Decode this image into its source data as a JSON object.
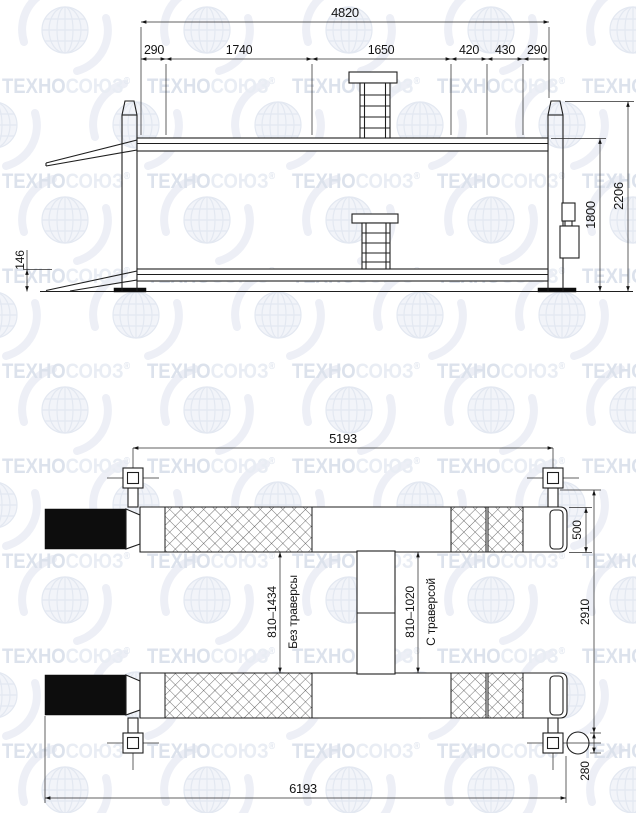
{
  "title": "Four-post lift dimensional drawing",
  "watermark": {
    "brand_left": "ТЕХНО",
    "brand_right": "СОЮЗ",
    "registered": "®"
  },
  "side_view": {
    "dim_overall_length": "4820",
    "dim_segments": [
      "290",
      "1740",
      "1650",
      "420",
      "430",
      "290"
    ],
    "dim_column_height": "2206",
    "dim_lift_height": "1800",
    "dim_platform_profile": "146"
  },
  "plan_view": {
    "dim_span_post_centers": "5193",
    "dim_overall_length": "6193",
    "dim_runway_width": "500",
    "dim_overall_width": "2910",
    "dim_motor_offset": "280",
    "label_without_traverse": {
      "range": "810–1434",
      "caption": "Без траверсы"
    },
    "label_with_traverse": {
      "range": "810–1020",
      "caption": "С траверсой"
    }
  },
  "colors": {
    "background": "#ffffff",
    "line": "#1e1e1e",
    "dimension_text": "#141414",
    "watermark_dark": "#dce2ec",
    "watermark_light": "#e9edf4",
    "black_fill": "#0d0d0d"
  }
}
